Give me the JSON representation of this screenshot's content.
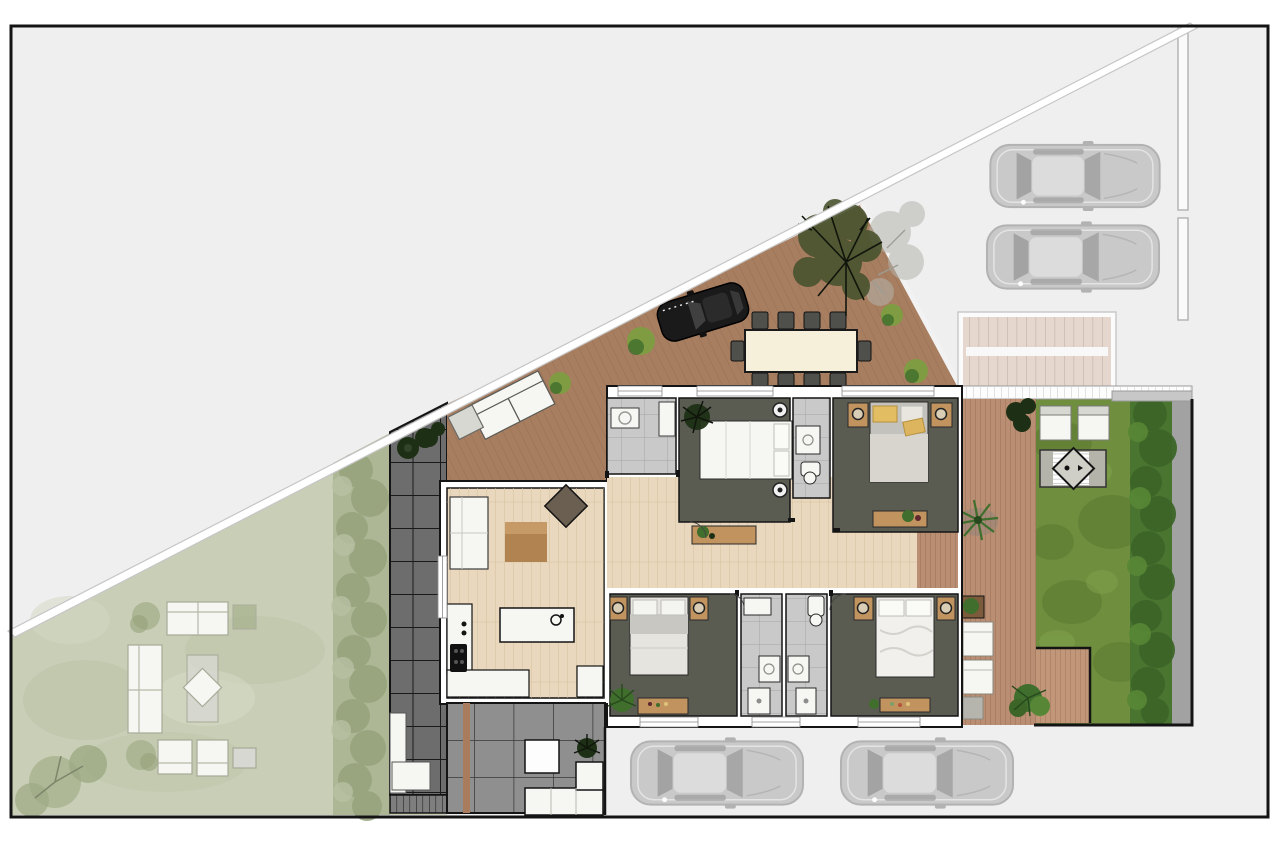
{
  "document": {
    "type": "architectural site plan",
    "view": "top-down rendered floor plan of a single-storey house with deck, gardens and parking",
    "visible_text": "none"
  },
  "palette": {
    "page": "#ffffff",
    "frame": "#141414",
    "road": "#efefef",
    "boundary_line": "#c6c6c6",
    "lawn_muted": "#c9cfb7",
    "lawn_muted_dark": "#bcc3a8",
    "lawn_muted_light": "#d4d8c3",
    "hedge_muted": "#aab491",
    "hedge_muted_dark": "#96a27c",
    "path_dark": "#6d6d6d",
    "path_grid": "#1a1a1a",
    "paver": "#8f8f8f",
    "paver_grid": "#383838",
    "deck": "#a87e60",
    "deck_line": "#8a634c",
    "deck_east": "#ba8e72",
    "deck_patio": "#c29678",
    "platform": "#e5d7ce",
    "platform_line": "#c8b6ab",
    "lawn_green": "#6f8e3e",
    "lawn_green_dark": "#5c7a30",
    "lawn_green_light": "#82a34e",
    "hedge_green": "#4a7531",
    "hedge_green_dark": "#3c6527",
    "hedge_green_light": "#578736",
    "tree_olive": "#49532f",
    "tree_branch": "#10150c",
    "tree_faded": "#b4b4ac",
    "wall": "#ffffff",
    "wall_line": "#141414",
    "wood_floor": "#e9d8bd",
    "wood_floor_line": "#d5bf9c",
    "room_dark": "#5a5c52",
    "tile": "#c9c9c9",
    "tile_line": "#9e9e9e",
    "furn_white": "#f6f6f2",
    "furn_gray": "#d8d8d2",
    "furn_line": "#3c3c3c",
    "bench_wood": "#c0935f",
    "pillow_yellow": "#e3bd62",
    "table_cream": "#f6f0da",
    "chair_dark": "#4f4f4b",
    "car_gray": "#c9c9c9",
    "car_gray_line": "#b2b2b2",
    "car_window": "#a3a3a3",
    "car_black": "#1a1a1a",
    "plant_dark": "#1d2f15",
    "plant_green": "#3f6e2d",
    "plant_light": "#7f9c42",
    "spa_frame": "#b4b4ab"
  },
  "site": {
    "areas": [
      "street-and-driveway",
      "front-lawn-muted",
      "hedge-screen",
      "paved-side-path",
      "timber-deck-terrace",
      "house",
      "entry-platform",
      "rear-garden-lawn",
      "garden-hedge",
      "garden-side-deck",
      "garden-patio-deck",
      "rear-paved-patio",
      "parking-top-right",
      "parking-bottom"
    ],
    "vehicles": {
      "gray_cars_top_right": 2,
      "gray_cars_bottom": 2,
      "black_car_on_deck": 1
    },
    "rooms": [
      {
        "name": "living-kitchen",
        "floor": "light-wood"
      },
      {
        "name": "entry-laundry",
        "floor": "gray-tile"
      },
      {
        "name": "bedroom-1",
        "floor": "dark-gray"
      },
      {
        "name": "bathroom-1",
        "floor": "gray-tile"
      },
      {
        "name": "bedroom-2",
        "floor": "dark-gray"
      },
      {
        "name": "hallway",
        "floor": "light-wood"
      },
      {
        "name": "bedroom-3",
        "floor": "dark-gray"
      },
      {
        "name": "bathroom-2",
        "floor": "gray-tile"
      },
      {
        "name": "bathroom-3",
        "floor": "gray-tile"
      },
      {
        "name": "bedroom-4",
        "floor": "dark-gray"
      }
    ],
    "furniture": {
      "deck": [
        "dining-table-10-chairs",
        "outdoor-sofa",
        "side-table",
        "planter-pots",
        "shrubs",
        "olive-tree"
      ],
      "living_kitchen": [
        "sofa",
        "coffee-table-rug",
        "lounge-chair",
        "kitchen-island",
        "l-shaped-counter",
        "cooktop"
      ],
      "bedrooms": [
        "double-bed",
        "nightstands-with-lamps",
        "foot-bench-with-plants"
      ],
      "rear_garden": [
        "sun-loungers-x2",
        "diamond-spa",
        "palm-plant",
        "deck-chairs",
        "planter-box",
        "potted-plants"
      ],
      "front_lawn": [
        "outdoor-sofa-set",
        "rug-with-diamond-table",
        "armchairs-x2",
        "side-tables",
        "shrubs",
        "tree"
      ],
      "rear_patio": [
        "dining-table",
        "l-shaped-bench",
        "storage-bench",
        "steps",
        "potted-plant"
      ]
    }
  }
}
